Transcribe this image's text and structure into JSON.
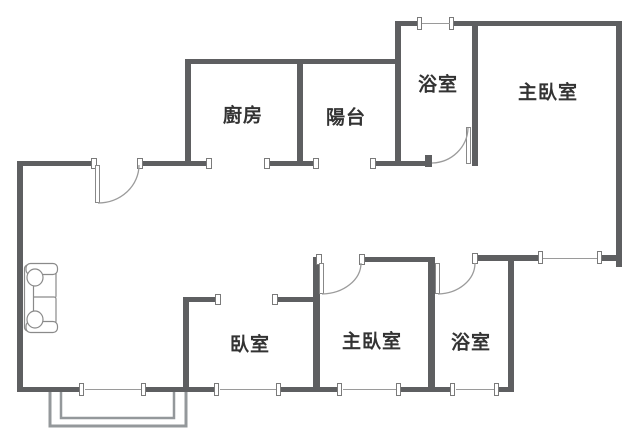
{
  "floorplan": {
    "rooms": [
      {
        "id": "kitchen",
        "label": "廚房"
      },
      {
        "id": "balcony",
        "label": "陽台"
      },
      {
        "id": "bathroom-top",
        "label": "浴室"
      },
      {
        "id": "master-bedroom-top",
        "label": "主臥室"
      },
      {
        "id": "bedroom",
        "label": "臥室"
      },
      {
        "id": "master-bedroom-bottom",
        "label": "主臥室"
      },
      {
        "id": "bathroom-bottom",
        "label": "浴室"
      }
    ],
    "furniture": [
      {
        "id": "sofa",
        "icon": "sofa-icon"
      }
    ],
    "symbols": {
      "door_swing": "quarter-circle-arc",
      "window": "thin-line-with-end-ticks",
      "balcony_rail": "double-line"
    },
    "colors": {
      "wall": "#5e5f61",
      "text": "#333333",
      "door_arc": "#9b9b9b",
      "window_line": "#9a9a9a",
      "balcony_line": "#94989b",
      "sofa_line": "#8a8a8a",
      "background": "#ffffff"
    }
  }
}
